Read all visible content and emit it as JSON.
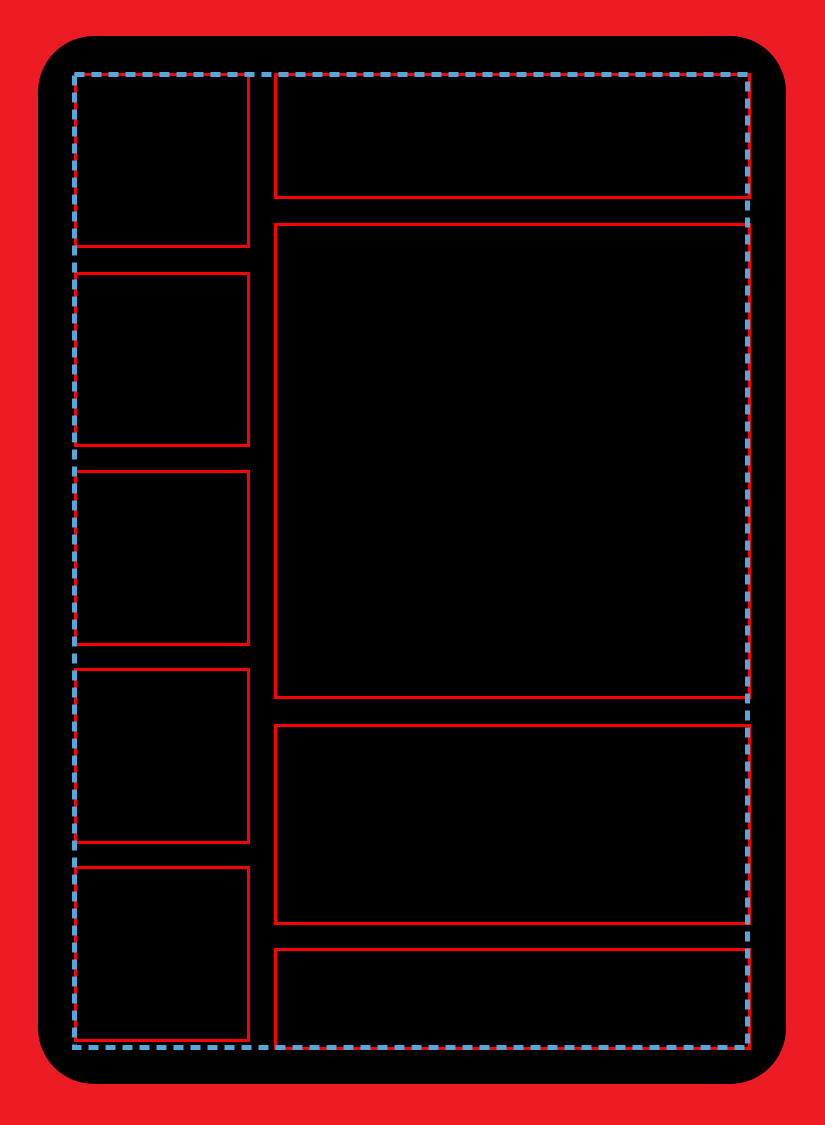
{
  "template": {
    "kind": "blank card/comic page layout template",
    "text_content": "none"
  },
  "colors": {
    "bleed_background_red": "#ED1C24",
    "card_black": "#000000",
    "panel_border_red": "#FF0000",
    "safe_area_dash_blue": "#55A9DA"
  },
  "guides": {
    "safe_area_border_style": "dashed",
    "dash_length_px": 10,
    "dash_gap_px": 7,
    "dash_thickness_px": 5
  },
  "panels": {
    "left_column": [
      {
        "id": "panel-left-1"
      },
      {
        "id": "panel-left-2"
      },
      {
        "id": "panel-left-3"
      },
      {
        "id": "panel-left-4"
      },
      {
        "id": "panel-left-5"
      }
    ],
    "right_column": [
      {
        "id": "panel-right-top"
      },
      {
        "id": "panel-right-main"
      },
      {
        "id": "panel-right-lower"
      },
      {
        "id": "panel-right-bottom"
      }
    ]
  }
}
